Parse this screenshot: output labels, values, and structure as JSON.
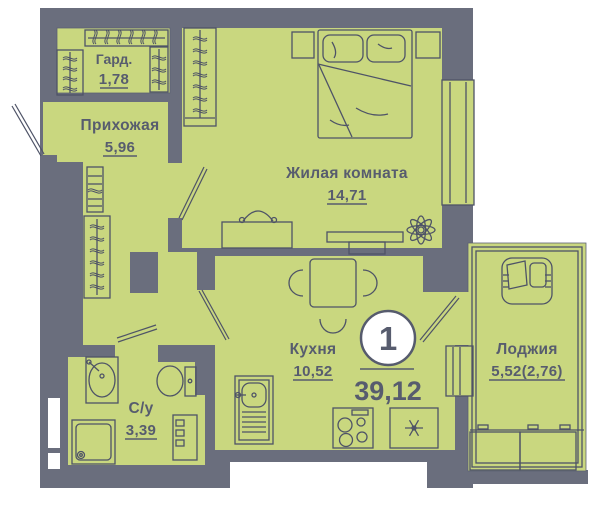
{
  "plan": {
    "title": "1-room apartment floor plan",
    "badge": {
      "rooms_count": "1",
      "total_area": "39,12"
    },
    "rooms": [
      {
        "id": "garderob",
        "label": "Гард.",
        "area": "1,78"
      },
      {
        "id": "hallway",
        "label": "Прихожая",
        "area": "5,96"
      },
      {
        "id": "living",
        "label": "Жилая комната",
        "area": "14,71"
      },
      {
        "id": "kitchen",
        "label": "Кухня",
        "area": "10,52"
      },
      {
        "id": "bathroom",
        "label": "С/у",
        "area": "3,39"
      },
      {
        "id": "loggia",
        "label": "Лоджия",
        "area": "5,52(2,76)"
      }
    ],
    "icons": [
      "bed-icon",
      "wardrobe-hangers-icon",
      "shoe-rack-icon",
      "desk-chair-icon",
      "tv-stand-icon",
      "plant-icon",
      "dining-table-icon",
      "chair-icon",
      "kitchen-sink-icon",
      "stove-icon",
      "fridge-snowflake-icon",
      "bath-sink-icon",
      "toilet-icon",
      "shower-icon",
      "washer-icon",
      "armchair-icon",
      "entrance-door-icon",
      "door-leaf-icon",
      "window-icon",
      "radiator-icon"
    ],
    "colors": {
      "background": "#ffffff",
      "wall": "#6a6e7d",
      "room_fill": "#c9d77f",
      "line": "#4e5367",
      "text": "#575c6e",
      "badge_bg": "#ffffff"
    }
  }
}
